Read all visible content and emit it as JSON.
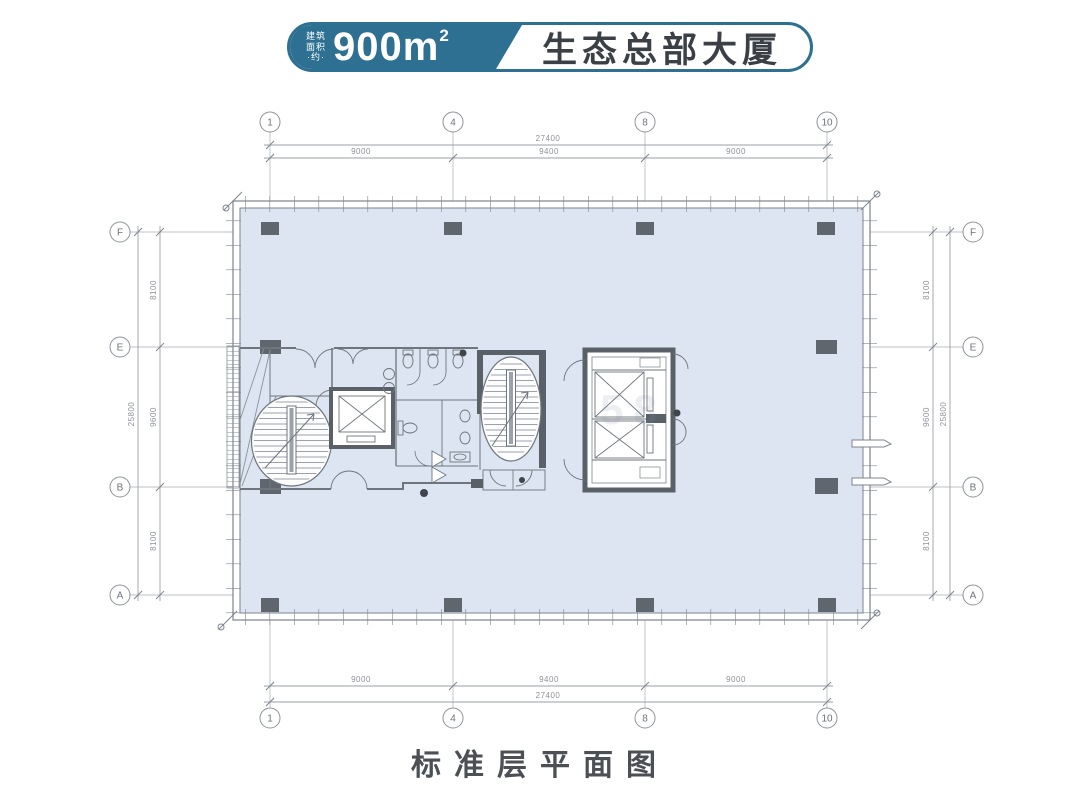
{
  "header": {
    "area_label_lines": [
      "建筑",
      "面积",
      "·约·"
    ],
    "area_value": "900",
    "area_unit": "m",
    "area_sup": "2",
    "building_name": "生态总部大厦",
    "accent_color": "#2d7091"
  },
  "plan": {
    "floor_fill": "#dce5f1",
    "wall_color": "#7d848e",
    "column_color": "#60666d",
    "core_wall_color": "#596067",
    "grid": {
      "top_labels": [
        "1",
        "4",
        "8",
        "10"
      ],
      "bottom_labels": [
        "1",
        "4",
        "8",
        "10"
      ],
      "left_labels": [
        "F",
        "E",
        "B",
        "A"
      ],
      "right_labels": [
        "F",
        "E",
        "B",
        "A"
      ]
    },
    "dimensions": {
      "total_width": "27400",
      "total_height": "25800",
      "width_segments": [
        "9000",
        "9400",
        "9000"
      ],
      "height_segments": [
        "8100",
        "9600",
        "8100"
      ]
    }
  },
  "watermark": "58",
  "caption": "标准层平面图"
}
